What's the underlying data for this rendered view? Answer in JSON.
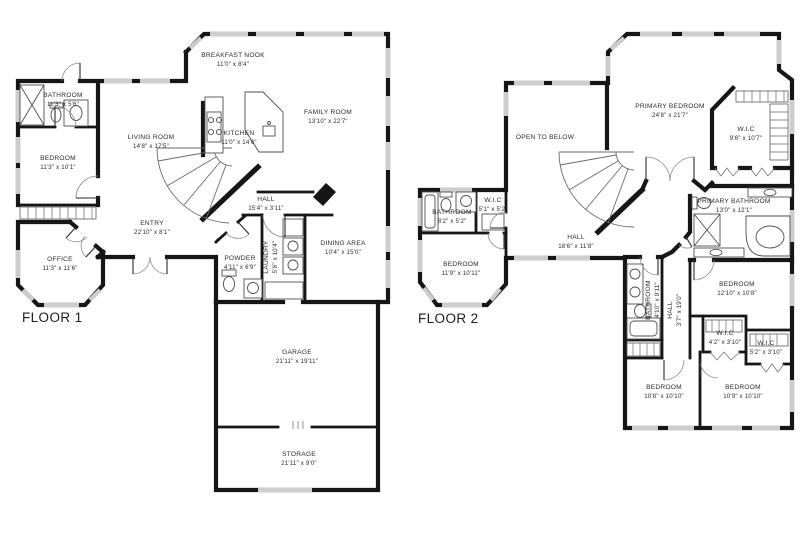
{
  "floor1": {
    "label": "FLOOR 1",
    "rooms": {
      "bathroom": {
        "name": "BATHROOM",
        "dims": "11'3\" x 5'6\""
      },
      "bedroom": {
        "name": "BEDROOM",
        "dims": "11'3\" x 10'1\""
      },
      "breakfast_nook": {
        "name": "BREAKFAST NOOK",
        "dims": "11'0\" x 8'4\""
      },
      "living_room": {
        "name": "LIVING ROOM",
        "dims": "14'8\" x 17'5\""
      },
      "kitchen": {
        "name": "KITCHEN",
        "dims": "11'0\" x 14'6\""
      },
      "family_room": {
        "name": "FAMILY ROOM",
        "dims": "13'10\" x 22'7\""
      },
      "entry": {
        "name": "ENTRY",
        "dims": "22'10\" x 8'1\""
      },
      "hall": {
        "name": "HALL",
        "dims": "15'4\" x 3'11\""
      },
      "office": {
        "name": "OFFICE",
        "dims": "11'3\" x 11'6\""
      },
      "powder": {
        "name": "POWDER",
        "dims": "4'11\" x 6'9\""
      },
      "laundry": {
        "name": "LAUNDRY",
        "dims": "5'8\" x 10'4\""
      },
      "dining_area": {
        "name": "DINING AREA",
        "dims": "10'4\" x 15'0\""
      },
      "garage": {
        "name": "GARAGE",
        "dims": "21'11\" x 19'11\""
      },
      "storage": {
        "name": "STORAGE",
        "dims": "21'11\" x 9'0\""
      }
    }
  },
  "floor2": {
    "label": "FLOOR 2",
    "rooms": {
      "open_to_below": {
        "name": "OPEN TO BELOW",
        "dims": ""
      },
      "primary_bedroom": {
        "name": "PRIMARY BEDROOM",
        "dims": "24'8\" x 21'7\""
      },
      "wic_primary": {
        "name": "W.I.C",
        "dims": "9'6\" x 10'7\""
      },
      "bathroom": {
        "name": "BATHROOM",
        "dims": "8'2\" x 5'2\""
      },
      "wic": {
        "name": "W.I.C",
        "dims": "5'1\" x 5'2\""
      },
      "primary_bathroom": {
        "name": "PRIMARY BATHROOM",
        "dims": "13'0\" x 12'1\""
      },
      "hall": {
        "name": "HALL",
        "dims": "18'6\" x 11'8\""
      },
      "bedroom_front": {
        "name": "BEDROOM",
        "dims": "11'9\" x 10'11\""
      },
      "bedroom_east": {
        "name": "BEDROOM",
        "dims": "12'10\" x 10'8\""
      },
      "bathroom2": {
        "name": "BATHROOM",
        "dims": "4'10\" x 9'11\""
      },
      "hall2": {
        "name": "HALL",
        "dims": "3'7\" x 19'0\""
      },
      "wic_a": {
        "name": "W.I.C",
        "dims": "4'2\" x 3'10\""
      },
      "wic_b": {
        "name": "W.I.C",
        "dims": "5'2\" x 3'10\""
      },
      "bedroom_sw": {
        "name": "BEDROOM",
        "dims": "10'8\" x 10'10\""
      },
      "bedroom_se": {
        "name": "BEDROOM",
        "dims": "10'9\" x 10'10\""
      }
    }
  }
}
